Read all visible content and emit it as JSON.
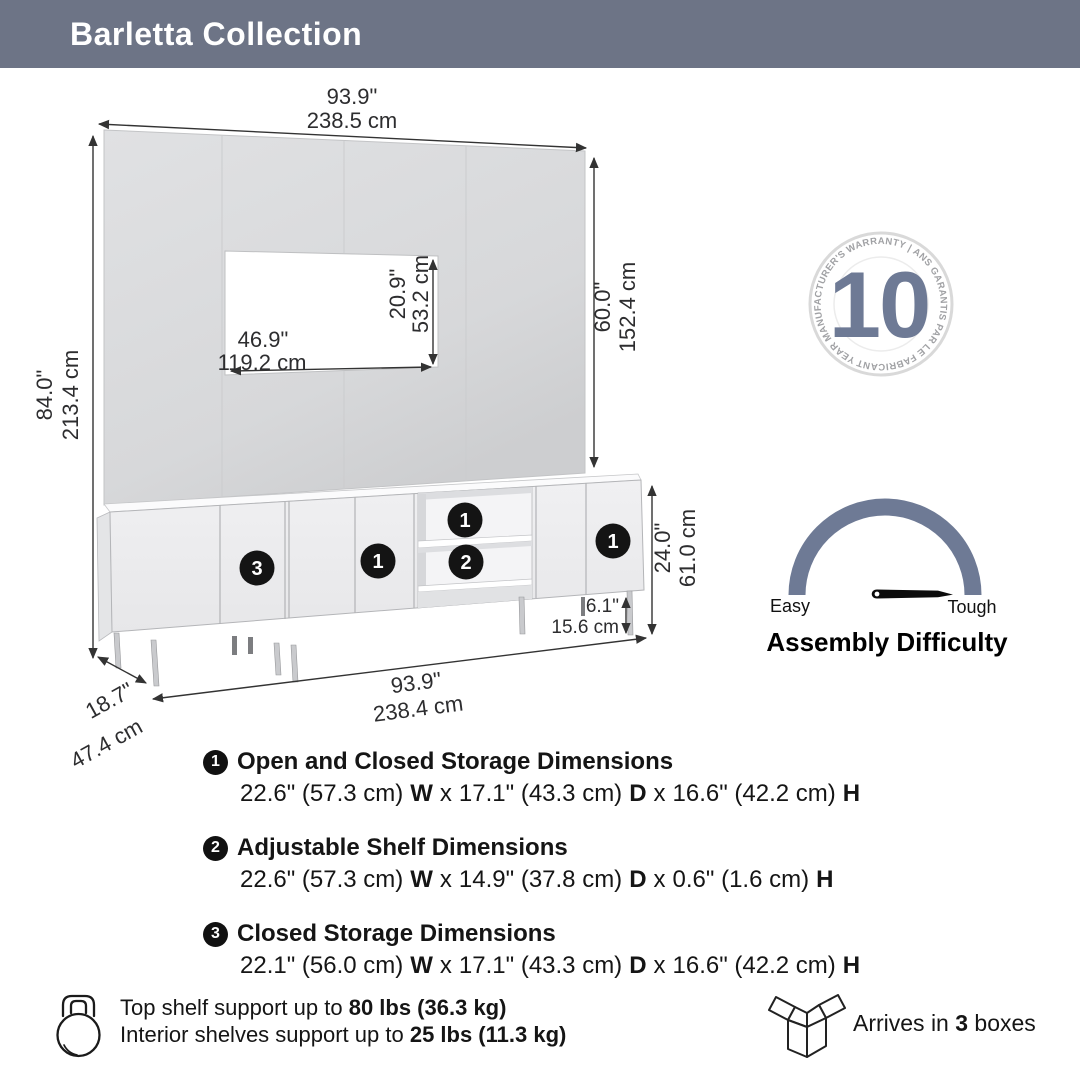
{
  "header": {
    "title": "Barletta Collection",
    "bg_color": "#6d7486"
  },
  "colors": {
    "accent_slate": "#6e7a95",
    "panel_gray": "#d9dadc",
    "dim_line": "#333333"
  },
  "dimensions": {
    "panel_width_in": "93.9\"",
    "panel_width_cm": "238.5 cm",
    "total_height_in": "84.0\"",
    "total_height_cm": "213.4 cm",
    "panel_height_in": "60.0\"",
    "panel_height_cm": "152.4 cm",
    "tv_opening_width_in": "46.9\"",
    "tv_opening_width_cm": "119.2 cm",
    "tv_opening_height_in": "20.9\"",
    "tv_opening_height_cm": "53.2 cm",
    "cabinet_height_in": "24.0\"",
    "cabinet_height_cm": "61.0 cm",
    "leg_height_in": "6.1\"",
    "leg_height_cm": "15.6 cm",
    "cabinet_width_in": "93.9\"",
    "cabinet_width_cm": "238.4 cm",
    "depth_in": "18.7\"",
    "depth_cm": "47.4 cm"
  },
  "warranty": {
    "number": "10",
    "ring_text": "YEAR MANUFACTURER'S WARRANTY   |   ANS GARANTIS PAR LE FABRICANT   |"
  },
  "gauge": {
    "easy_label": "Easy",
    "tough_label": "Tough",
    "title": "Assembly Difficulty"
  },
  "sep": "x",
  "callouts": [
    {
      "num": "1",
      "title": "Open and Closed Storage Dimensions",
      "w": "22.6\" (57.3 cm)",
      "w_label": "W",
      "d": "17.1\" (43.3 cm)",
      "d_label": "D",
      "h": "16.6\" (42.2 cm)",
      "h_label": "H"
    },
    {
      "num": "2",
      "title": "Adjustable Shelf Dimensions",
      "w": "22.6\" (57.3 cm)",
      "w_label": "W",
      "d": "14.9\" (37.8 cm)",
      "d_label": "D",
      "h": "0.6\" (1.6 cm)",
      "h_label": "H"
    },
    {
      "num": "3",
      "title": "Closed Storage Dimensions",
      "w": "22.1\" (56.0 cm)",
      "w_label": "W",
      "d": "17.1\" (43.3 cm)",
      "d_label": "D",
      "h": "16.6\" (42.2 cm)",
      "h_label": "H"
    }
  ],
  "support": {
    "line1_prefix": "Top shelf support up to ",
    "line1_bold": "80 lbs (36.3 kg)",
    "line2_prefix": "Interior shelves support up to ",
    "line2_bold": "25 lbs (11.3 kg)"
  },
  "shipping": {
    "prefix": "Arrives in ",
    "count": "3",
    "suffix": " boxes"
  }
}
